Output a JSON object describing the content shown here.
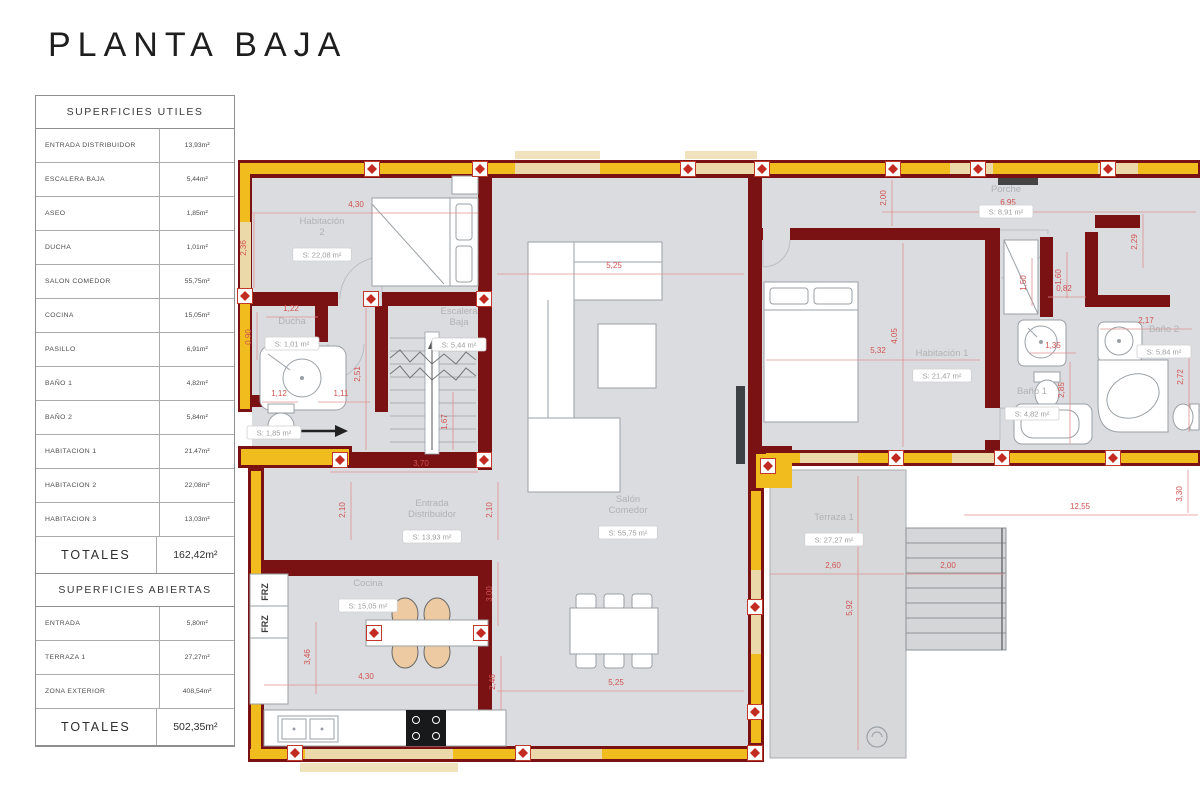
{
  "title": "PLANTA BAJA",
  "tables": {
    "utiles": {
      "header": "SUPERFICIES UTILES",
      "rows": [
        [
          "ENTRADA DISTRIBUIDOR",
          "13,93m²"
        ],
        [
          "ESCALERA BAJA",
          "5,44m²"
        ],
        [
          "ASEO",
          "1,85m²"
        ],
        [
          "DUCHA",
          "1,01m²"
        ],
        [
          "SALON COMEDOR",
          "55,75m²"
        ],
        [
          "COCINA",
          "15,05m²"
        ],
        [
          "PASILLO",
          "6,91m²"
        ],
        [
          "BAÑO 1",
          "4,82m²"
        ],
        [
          "BAÑO 2",
          "5,84m²"
        ],
        [
          "HABITACION 1",
          "21,47m²"
        ],
        [
          "HABITACION 2",
          "22,08m²"
        ],
        [
          "HABITACION 3",
          "13,03m²"
        ]
      ],
      "total_label": "TOTALES",
      "total_value": "162,42m²"
    },
    "abiertas": {
      "header": "SUPERFICIES ABIERTAS",
      "rows": [
        [
          "ENTRADA",
          "5,80m²"
        ],
        [
          "TERRAZA 1",
          "27,27m²"
        ],
        [
          "ZONA EXTERIOR",
          "408,54m²"
        ]
      ],
      "total_label": "TOTALES",
      "total_value": "502,35m²"
    }
  },
  "plan": {
    "frz": [
      {
        "t": "FRZ",
        "x": 268,
        "y": 592
      },
      {
        "t": "FRZ",
        "x": 268,
        "y": 624
      }
    ],
    "rooms": [
      {
        "lines": [
          "Habitación",
          "2"
        ],
        "area": "S: 22,08 m²",
        "x": 322,
        "y": 224
      },
      {
        "lines": [
          "Escalera",
          "Baja"
        ],
        "area": "S: 5,44 m²",
        "x": 459,
        "y": 314
      },
      {
        "lines": [
          "Ducha"
        ],
        "area": "S: 1,01 m²",
        "x": 292,
        "y": 324
      },
      {
        "lines": [],
        "area": "S: 1,85 m²",
        "x": 274,
        "y": 424
      },
      {
        "lines": [
          "Entrada",
          "Distribuidor"
        ],
        "area": "S: 13,93 m²",
        "x": 432,
        "y": 506
      },
      {
        "lines": [
          "Cocina"
        ],
        "area": "S: 15,05 m²",
        "x": 368,
        "y": 586
      },
      {
        "lines": [
          "Salón",
          "Comedor"
        ],
        "area": "S: 55,75 m²",
        "x": 628,
        "y": 502
      },
      {
        "lines": [
          "Habitación 1"
        ],
        "area": "S: 21,47 m²",
        "x": 942,
        "y": 356
      },
      {
        "lines": [
          "Porche"
        ],
        "area": "S: 8,91 m²",
        "x": 1006,
        "y": 192
      },
      {
        "lines": [
          "Baño 1"
        ],
        "area": "S: 4,82 m²",
        "x": 1032,
        "y": 394
      },
      {
        "lines": [
          "Baño 2"
        ],
        "area": "S: 5,84 m²",
        "x": 1164,
        "y": 332
      },
      {
        "lines": [
          "Terraza 1"
        ],
        "area": "S: 27,27 m²",
        "x": 834,
        "y": 520
      }
    ],
    "dims": [
      {
        "v": "4,30",
        "x": 356,
        "y": 207,
        "line": [
          252,
          213,
          478,
          213
        ]
      },
      {
        "v": "2,36",
        "x": 246,
        "y": 248,
        "rot": 1,
        "line": [
          254,
          214,
          254,
          288
        ]
      },
      {
        "v": "5,25",
        "x": 614,
        "y": 268,
        "line": [
          497,
          274,
          744,
          274
        ]
      },
      {
        "v": "6,95",
        "x": 1008,
        "y": 205,
        "line": [
          882,
          212,
          1196,
          212
        ]
      },
      {
        "v": "2,00",
        "x": 886,
        "y": 198,
        "rot": 1,
        "line": [
          892,
          180,
          892,
          226
        ]
      },
      {
        "v": "2,29",
        "x": 1137,
        "y": 242,
        "rot": 1,
        "line": [
          1143,
          214,
          1143,
          268
        ]
      },
      {
        "v": "5,32",
        "x": 878,
        "y": 353,
        "line": [
          766,
          360,
          980,
          360
        ]
      },
      {
        "v": "4,05",
        "x": 897,
        "y": 336,
        "rot": 1,
        "line": [
          903,
          243,
          903,
          447
        ]
      },
      {
        "v": "1,50",
        "x": 1026,
        "y": 283,
        "rot": 1,
        "line": [
          1032,
          258,
          1032,
          306
        ]
      },
      {
        "v": "1,60",
        "x": 1061,
        "y": 277,
        "rot": 1,
        "line": [
          1067,
          252,
          1067,
          298
        ]
      },
      {
        "v": "0,82",
        "x": 1064,
        "y": 291,
        "line": [
          1048,
          297,
          1086,
          297
        ]
      },
      {
        "v": "2,17",
        "x": 1146,
        "y": 323,
        "line": [
          1100,
          329,
          1192,
          329
        ]
      },
      {
        "v": "1,35",
        "x": 1053,
        "y": 348,
        "line": [
          1030,
          353,
          1076,
          353
        ]
      },
      {
        "v": "2,85",
        "x": 1064,
        "y": 390,
        "rot": 1,
        "line": [
          1070,
          362,
          1070,
          444
        ]
      },
      {
        "v": "2,72",
        "x": 1183,
        "y": 377,
        "rot": 1,
        "line": [
          1189,
          354,
          1189,
          432
        ]
      },
      {
        "v": "1,22",
        "x": 291,
        "y": 311,
        "line": [
          266,
          317,
          318,
          317
        ]
      },
      {
        "v": "0,90",
        "x": 251,
        "y": 337,
        "rot": 1,
        "line": [
          257,
          312,
          257,
          360
        ]
      },
      {
        "v": "2,51",
        "x": 360,
        "y": 374,
        "rot": 1,
        "line": [
          366,
          308,
          366,
          450
        ]
      },
      {
        "v": "1,12",
        "x": 279,
        "y": 396,
        "line": [
          262,
          402,
          298,
          402
        ]
      },
      {
        "v": "1,11",
        "x": 341,
        "y": 396,
        "line": [
          318,
          402,
          370,
          402
        ]
      },
      {
        "v": "1,67",
        "x": 447,
        "y": 422,
        "rot": 1,
        "line": [
          453,
          392,
          453,
          450
        ]
      },
      {
        "v": "3,70",
        "x": 421,
        "y": 466,
        "line": [
          330,
          472,
          478,
          472
        ]
      },
      {
        "v": "2,10",
        "x": 345,
        "y": 510,
        "rot": 1,
        "line": [
          351,
          482,
          351,
          540
        ]
      },
      {
        "v": "2,10",
        "x": 492,
        "y": 510,
        "rot": 1,
        "line": [
          498,
          482,
          498,
          540
        ]
      },
      {
        "v": "3,00",
        "x": 492,
        "y": 594,
        "rot": 1,
        "line": [
          498,
          562,
          498,
          626
        ]
      },
      {
        "v": "3,46",
        "x": 310,
        "y": 657,
        "rot": 1,
        "line": [
          316,
          622,
          316,
          694
        ]
      },
      {
        "v": "4,30",
        "x": 366,
        "y": 679,
        "line": [
          264,
          685,
          478,
          685
        ]
      },
      {
        "v": "2,46",
        "x": 495,
        "y": 682,
        "rot": 1,
        "line": [
          501,
          656,
          501,
          710
        ]
      },
      {
        "v": "5,25",
        "x": 616,
        "y": 685,
        "line": [
          497,
          691,
          744,
          691
        ]
      },
      {
        "v": "2,60",
        "x": 833,
        "y": 568,
        "line": [
          770,
          574,
          904,
          574
        ]
      },
      {
        "v": "2,00",
        "x": 948,
        "y": 568,
        "line": [
          906,
          574,
          1004,
          574
        ]
      },
      {
        "v": "5,92",
        "x": 852,
        "y": 608,
        "rot": 1,
        "line": [
          858,
          476,
          858,
          750
        ]
      },
      {
        "v": "12,55",
        "x": 1080,
        "y": 509,
        "line": [
          964,
          515,
          1198,
          515
        ]
      },
      {
        "v": "3,30",
        "x": 1182,
        "y": 494,
        "rot": 1,
        "line": [
          1188,
          470,
          1188,
          513
        ]
      }
    ]
  }
}
